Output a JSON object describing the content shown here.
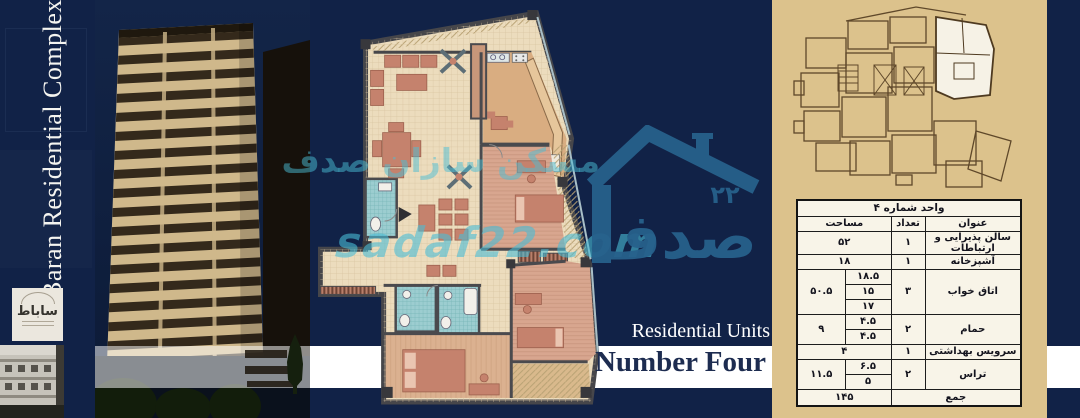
{
  "meta": {
    "title_vertical": "Baran Residential Complex"
  },
  "palette": {
    "navy_background": "#112247",
    "cream_panel": "#dcc28c",
    "banner_white": "#ffffff",
    "watermark_teal": "#4abdd6",
    "logo_steel_blue": "#27618c",
    "plan_floor_cream": "#ecdcbd",
    "plan_furniture_salmon": "#c5826d",
    "plan_bathroom_teal": "#9ccdd0",
    "caption_navy": "#1d2c50"
  },
  "captions": {
    "units_label": "Residential Units",
    "unit_name": "Number Four"
  },
  "watermark": {
    "brand_fa": "مسکن سازان صدف",
    "domain": "sadaf22.com",
    "logo_text_fa": "صدف",
    "logo_number_fa": "۲۲"
  },
  "developer_card": {
    "name_fa": "ساباط"
  },
  "unit_table": {
    "title": "واحد شماره ۴",
    "columns": {
      "name": "عنوان",
      "count": "تعداد",
      "area": "مساحت"
    },
    "rows": [
      {
        "name": "سالن پذیرایی و ارتباطات",
        "count": "۱",
        "area": "۵۲",
        "subs": []
      },
      {
        "name": "آشپزخانه",
        "count": "۱",
        "area": "۱۸",
        "subs": []
      },
      {
        "name": "اتاق خواب",
        "count": "۳",
        "area": "۵۰.۵",
        "subs": [
          "۱۸.۵",
          "۱۵",
          "۱۷"
        ]
      },
      {
        "name": "حمام",
        "count": "۲",
        "area": "۹",
        "subs": [
          "۴.۵",
          "۴.۵"
        ]
      },
      {
        "name": "سرویس بهداشتی",
        "count": "۱",
        "area": "۴",
        "subs": []
      },
      {
        "name": "تراس",
        "count": "۲",
        "area": "۱۱.۵",
        "subs": [
          "۶.۵",
          "۵"
        ]
      }
    ],
    "total_label": "جمع",
    "total_area": "۱۴۵"
  }
}
